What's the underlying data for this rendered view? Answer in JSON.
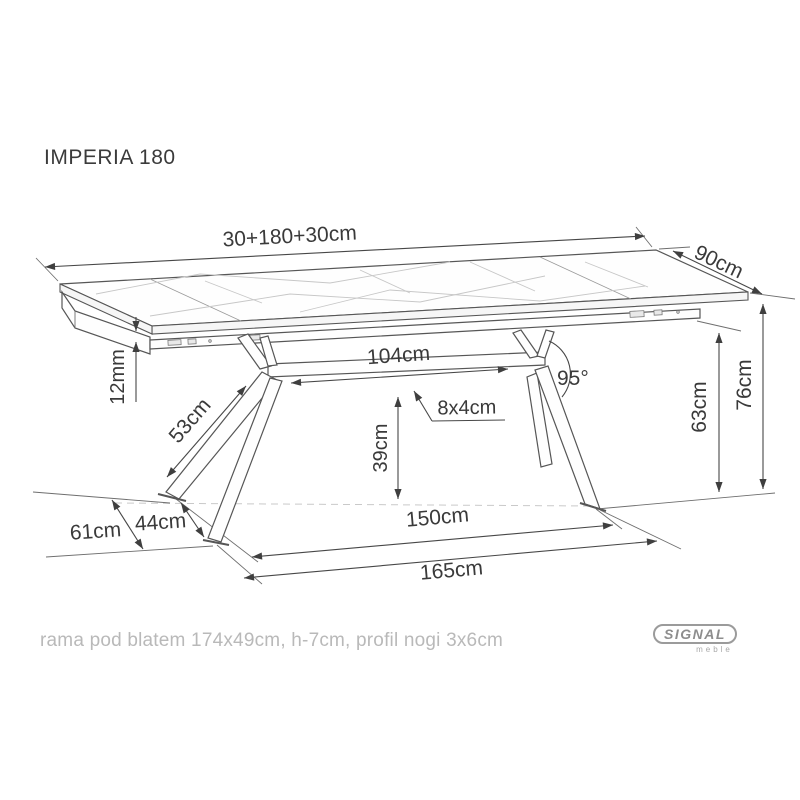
{
  "title": "IMPERIA 180",
  "caption": "rama pod blatem 174x49cm, h-7cm, profil nogi 3x6cm",
  "logo": {
    "brand": "SIGNAL",
    "sub": "meble"
  },
  "colors": {
    "line": "#565656",
    "dim_text": "#3a3a3a",
    "caption_text": "#b9b9b9",
    "logo_gray": "#8d8d8d",
    "background": "#ffffff"
  },
  "dimensions": {
    "top_length": "30+180+30cm",
    "top_depth": "90cm",
    "top_thickness": "12mm",
    "leg_length": "53cm",
    "beam_length": "104cm",
    "beam_profile": "8x4cm",
    "beam_clearance": "39cm",
    "leg_angle": "95°",
    "frame_clearance": "63cm",
    "table_height": "76cm",
    "feet_depth_outer": "61cm",
    "feet_depth_inner": "44cm",
    "feet_span_inner": "150cm",
    "feet_span_outer": "165cm"
  }
}
